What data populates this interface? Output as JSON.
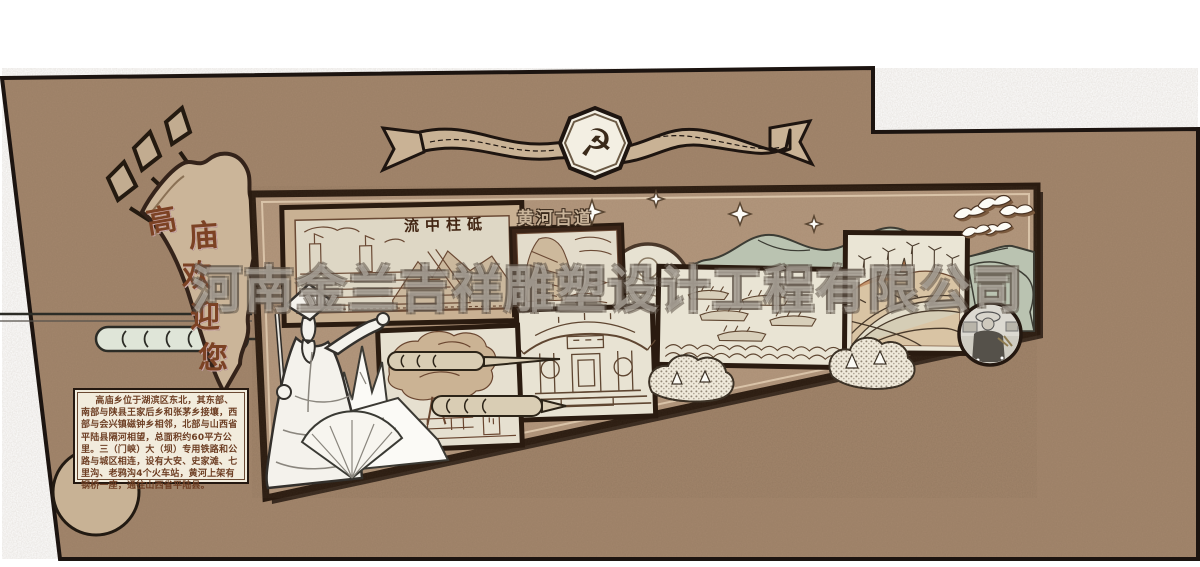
{
  "watermark": {
    "text": "河南金兰吉祥雕塑设计工程有限公司"
  },
  "banner": {
    "emblem_icon": "hammer-and-sickle-icon",
    "emblem_glyph": "☭"
  },
  "welcome_flag": {
    "text": "高庙欢迎您",
    "chars": [
      "高",
      "庙",
      "欢",
      "迎",
      "您"
    ]
  },
  "intro_plaque": {
    "text": "高庙乡位于湖滨区东北，其东部、南部与陕县王家后乡和张茅乡接壤，西部与会兴镇磁钟乡相邻，北部与山西省平陆县隔河相望，总面积约60平方公里。三（门峡）大（坝）专用铁路和公路与城区相连，设有大安、史家滩、七里沟、老鸦沟4个火车站，黄河上架有钢桥一座，通往山西省平陆县。"
  },
  "panels": {
    "dam": {
      "title_display": "流中柱砥",
      "subject": "sanmenxia-dam-engraving"
    },
    "plank_road": {
      "title_display": "黄河古道",
      "subject": "yellow-river-cliff-engraving"
    },
    "dragon_boats": {
      "subject": "dragon-boat-fleet-engraving"
    },
    "temple": {
      "subject": "temple-pavilion-engraving"
    },
    "ancient_tree": {
      "subject": "ancient-tree-engraving"
    },
    "terraced_fields": {
      "subject": "terraced-fields-wind-turbines-engraving"
    },
    "farmer_photo": {
      "subject": "farmer-portrait-photo"
    },
    "moon_medallion": {
      "subject": "moon-clouds-vignette"
    }
  },
  "decorations": [
    "spear-flagpoles",
    "ribbon-banner",
    "cloud-scrolls",
    "green-mountain-silhouette",
    "white-mountains",
    "statue-of-sage",
    "folding-fan",
    "doves",
    "sparkle-stars",
    "stippled-bushes",
    "corner-circle"
  ],
  "colors": {
    "wall": "#a3866c",
    "board": "#b3977d",
    "frame_dark": "#2a1b10",
    "panel_paper": "#e8e2d2",
    "ribbon_tan": "#c9b295",
    "text_brown": "#7c4224",
    "mountain_green": "#bac3b1",
    "plaque_bg": "#f2ecdd",
    "watermark_fill": "rgba(250,246,238,0.38)"
  }
}
